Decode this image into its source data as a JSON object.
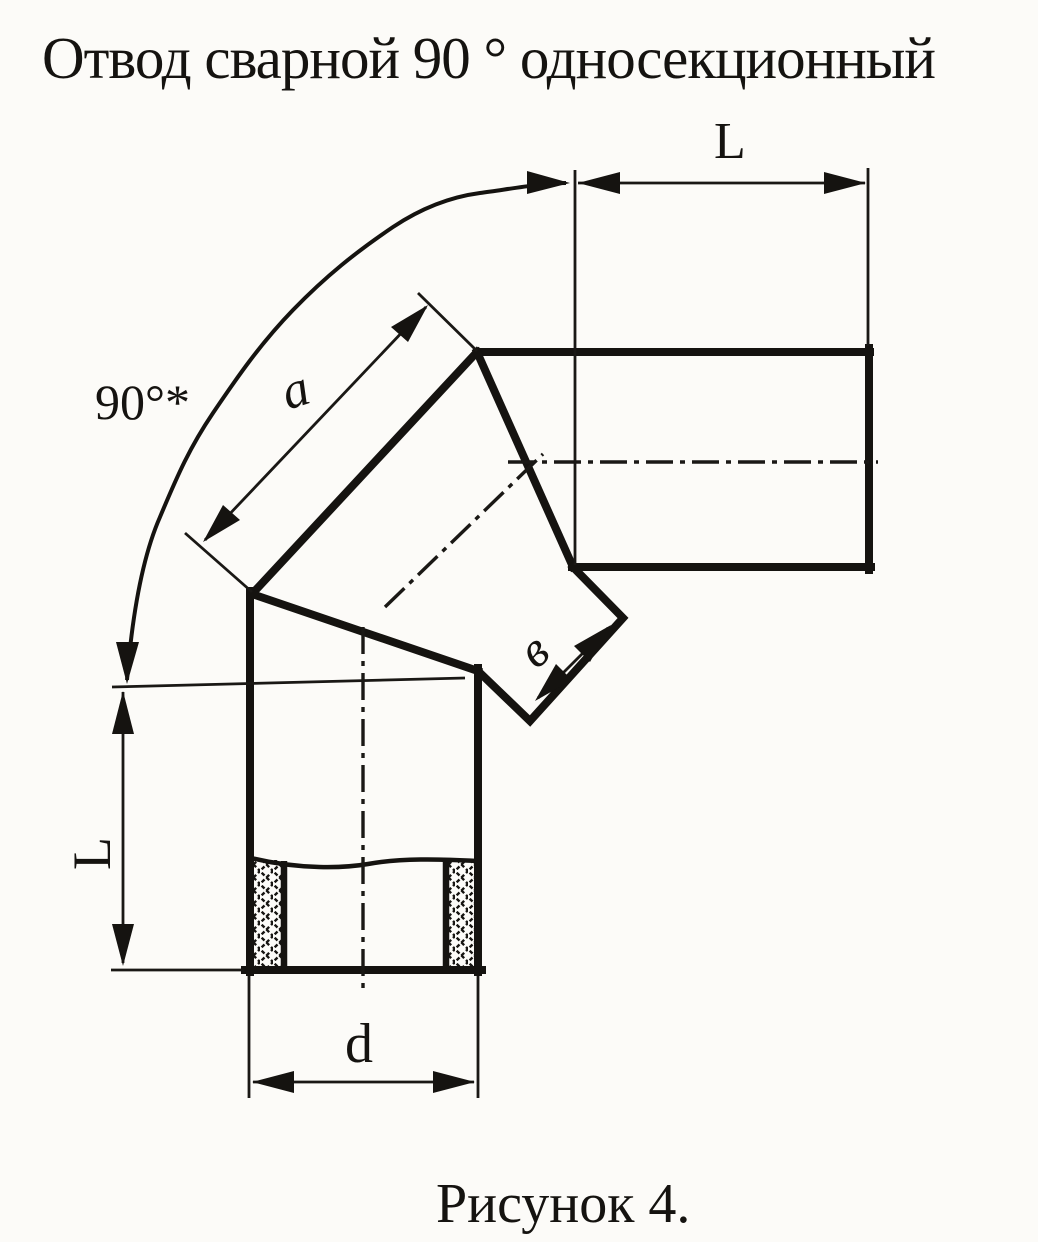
{
  "page": {
    "title": "Отвод сварной 90 ° односекционный",
    "caption": "Рисунок 4."
  },
  "drawing": {
    "labels": {
      "length_top": "L",
      "length_left": "L",
      "segment_a": "a",
      "face_width": "в",
      "diameter": "d",
      "angle": "90°*"
    },
    "colors": {
      "ink": "#151310",
      "paper": "#fcfbf8"
    }
  }
}
